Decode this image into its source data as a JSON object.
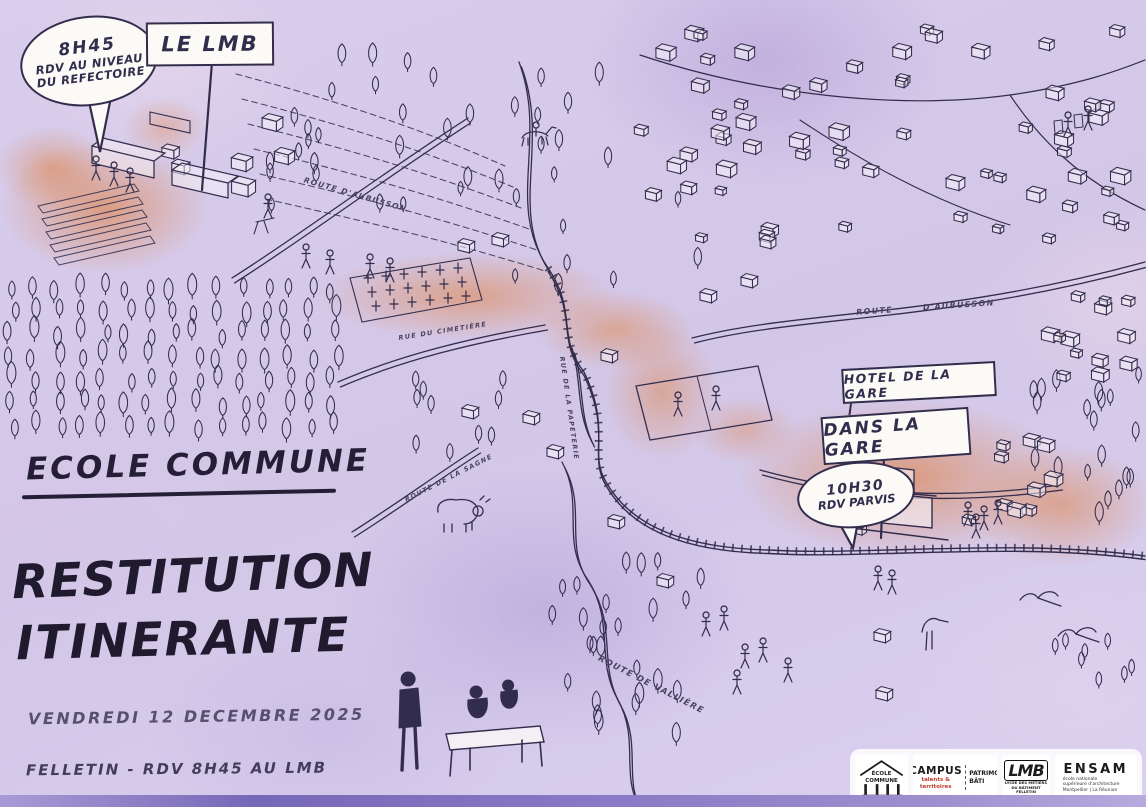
{
  "colors": {
    "ink": "#332d4d",
    "accent_orange": "#dd7a33",
    "wash_lavender": "#d6cbea",
    "footer_purple": "#7b6cc0",
    "paper_white": "#fbfaf7"
  },
  "callouts": {
    "refectoire_bubble": {
      "line1": "8H45",
      "line2": "RDV AU NIVEAU",
      "line3": "DU REFECTOIRE"
    },
    "parvis_bubble": {
      "line1": "10H30",
      "line2": "RDV PARVIS"
    }
  },
  "signs": {
    "lmb": "LE LMB",
    "hotel_de_la_gare": "HOTEL DE LA GARE",
    "dans_la_gare": "DANS LA GARE"
  },
  "titles": {
    "series": "ECOLE COMMUNE",
    "main_line1": "RESTITUTION",
    "main_line2": "ITINERANTE",
    "date": "VENDREDI 12 DECEMBRE 2025",
    "location": "FELLETIN  -  RDV 8H45 AU LMB"
  },
  "road_labels": [
    {
      "text": "ROUTE D'AUBUSSON"
    },
    {
      "text": "ROUTE D'AUBUSSON"
    },
    {
      "text": "RUE DU CIMETIÈRE"
    },
    {
      "text": "ROUTE DE LA SAGNE"
    },
    {
      "text": "RUE DE LA PAPETERIE"
    },
    {
      "text": "ROUTE DE VALLIÈRE"
    }
  ],
  "footer_logos": {
    "ecole_commune": {
      "name": "ÉCOLE COMMUNE"
    },
    "campus": {
      "name": "CAMPUS",
      "sub": "talents & territoires",
      "right": "PATRIMOINE BÂTI"
    },
    "lmb": {
      "name": "LMB",
      "line2": "LYCÉE DES MÉTIERS DU BÂTIMENT",
      "line3": "FELLETIN"
    },
    "ensam": {
      "name": "ENSAM",
      "line2": "école nationale",
      "line3": "supérieure d'architecture",
      "line4": "Montpellier | La Réunion"
    }
  },
  "illustrations": [
    "hand-drawn-town-map",
    "railway-track",
    "forest",
    "cemetery",
    "sports-field",
    "train-station",
    "cow",
    "horse-rider",
    "storks",
    "picnic-scene",
    "walkers",
    "timber-workers",
    "hikers",
    "terraced-fields"
  ]
}
